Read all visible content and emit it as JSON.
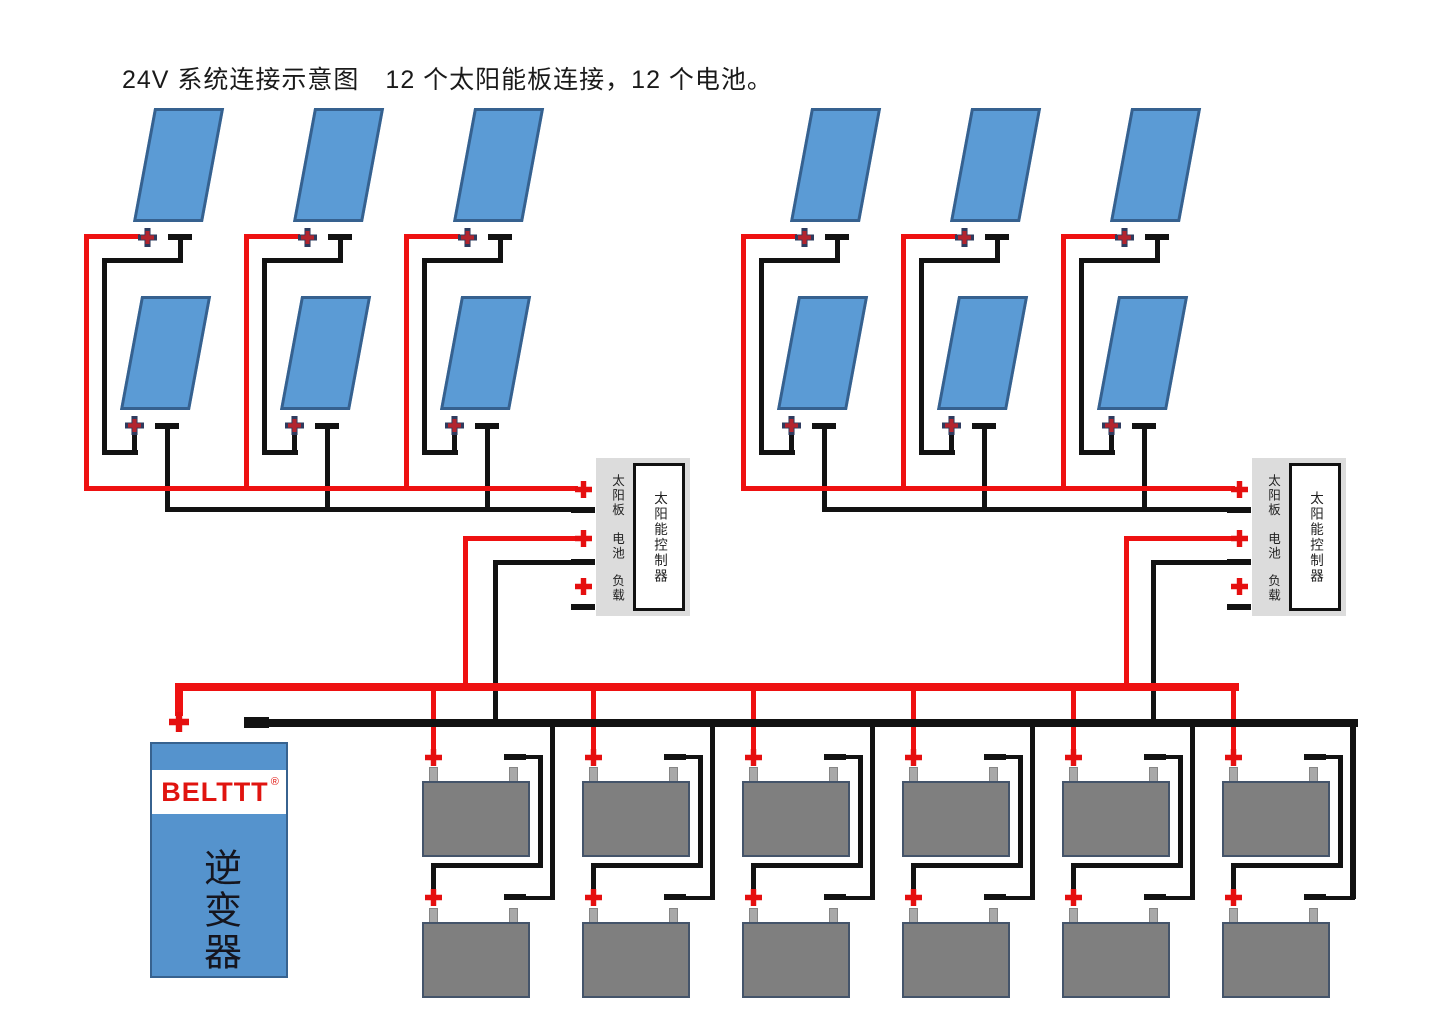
{
  "title": "24V 系统连接示意图　12 个太阳能板连接，12 个电池。",
  "controller": {
    "name": "太阳能控制器",
    "port_pv": "太阳板",
    "port_battery": "电池",
    "port_load": "负载"
  },
  "inverter": {
    "brand": "BELTTT",
    "reg": "®",
    "name": "逆变器"
  },
  "counts": {
    "solar_panels": 12,
    "batteries": 12,
    "controllers": 2,
    "inverters": 1
  },
  "colors": {
    "positive_wire": "#ee1111",
    "negative_wire": "#121212",
    "panel_fill": "#5b9bd5",
    "battery_fill": "#7f7f7f",
    "controller_bg": "#dcdcdc",
    "inverter_fill": "#5593cd",
    "brand_red": "#e0140f"
  }
}
